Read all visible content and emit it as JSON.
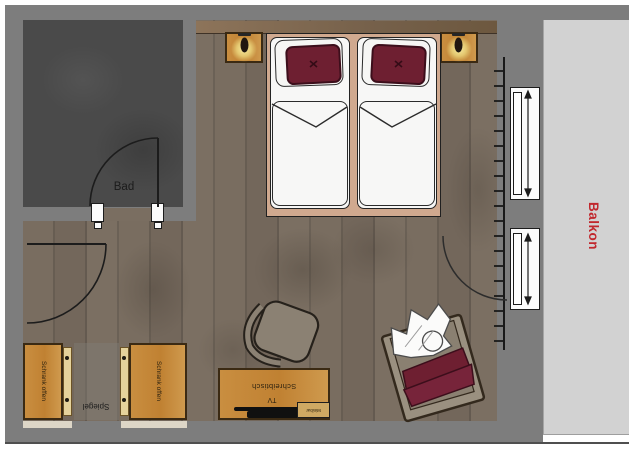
{
  "rooms": {
    "bathroom": {
      "label": "Bad"
    },
    "balcony": {
      "label": "Balkon",
      "label_color": "#c1272d"
    }
  },
  "furniture": {
    "wardrobe_left": {
      "label": "Schrank offen"
    },
    "wardrobe_right": {
      "label": "Schrank offen"
    },
    "mirror": {
      "label": "Spiegel"
    },
    "desk": {
      "label": "Schreibtisch"
    },
    "tv": {
      "label": "TV"
    },
    "minibar": {
      "label": "Minibar"
    }
  },
  "colors": {
    "wall": "#7d7d7d",
    "bathroom_floor": "#4a4a4a",
    "wood_floor": "#75695d",
    "furniture_wood": "#c5893c",
    "bed_linen": "#f7f7f6",
    "pillow_accent": "#6e1f31",
    "bed_frame": "#d0a98f",
    "balcony_floor": "#d2d2d2",
    "balcony_label": "#c1272d",
    "lamp_glow": "#f6eb9b"
  }
}
